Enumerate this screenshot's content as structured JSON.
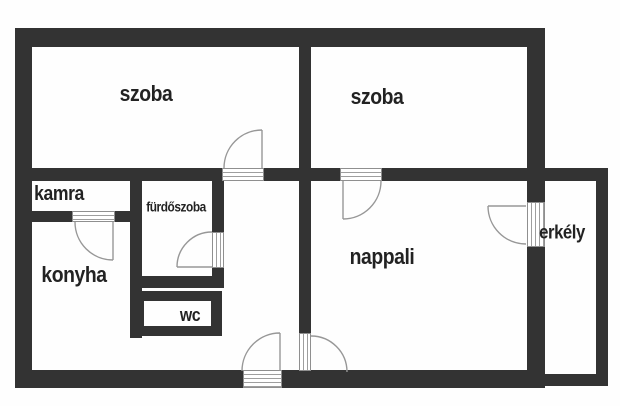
{
  "floor_plan": {
    "type": "apartment-floor-plan",
    "rooms": [
      {
        "id": "szoba-1",
        "label": "szoba"
      },
      {
        "id": "szoba-2",
        "label": "szoba"
      },
      {
        "id": "kamra",
        "label": "kamra"
      },
      {
        "id": "furdoszoba",
        "label": "fürdőszoba"
      },
      {
        "id": "konyha",
        "label": "konyha"
      },
      {
        "id": "wc",
        "label": "wc"
      },
      {
        "id": "nappali",
        "label": "nappali"
      },
      {
        "id": "erkely",
        "label": "erkély"
      }
    ],
    "doors": [
      {
        "id": "door-szoba-1",
        "between": [
          "szoba-1",
          "hallway"
        ],
        "swings_into": "szoba-1"
      },
      {
        "id": "door-szoba-2",
        "between": [
          "szoba-2",
          "nappali"
        ],
        "swings_into": "nappali"
      },
      {
        "id": "door-kamra",
        "between": [
          "kamra",
          "konyha"
        ],
        "swings_into": "konyha"
      },
      {
        "id": "door-furdoszoba",
        "between": [
          "furdoszoba",
          "hallway"
        ],
        "swings_into": "furdoszoba"
      },
      {
        "id": "door-nappali",
        "between": [
          "hallway",
          "nappali"
        ],
        "swings_into": "nappali"
      },
      {
        "id": "door-entrance",
        "between": [
          "outside",
          "hallway"
        ],
        "swings_into": "hallway"
      },
      {
        "id": "door-erkely",
        "between": [
          "nappali",
          "erkely"
        ],
        "swings_into": "nappali"
      }
    ],
    "colors": {
      "wall": "#333333",
      "door_line": "#979797",
      "sill_line": "#9e9e9e",
      "label": "#222222",
      "background": "#ffffff"
    }
  }
}
